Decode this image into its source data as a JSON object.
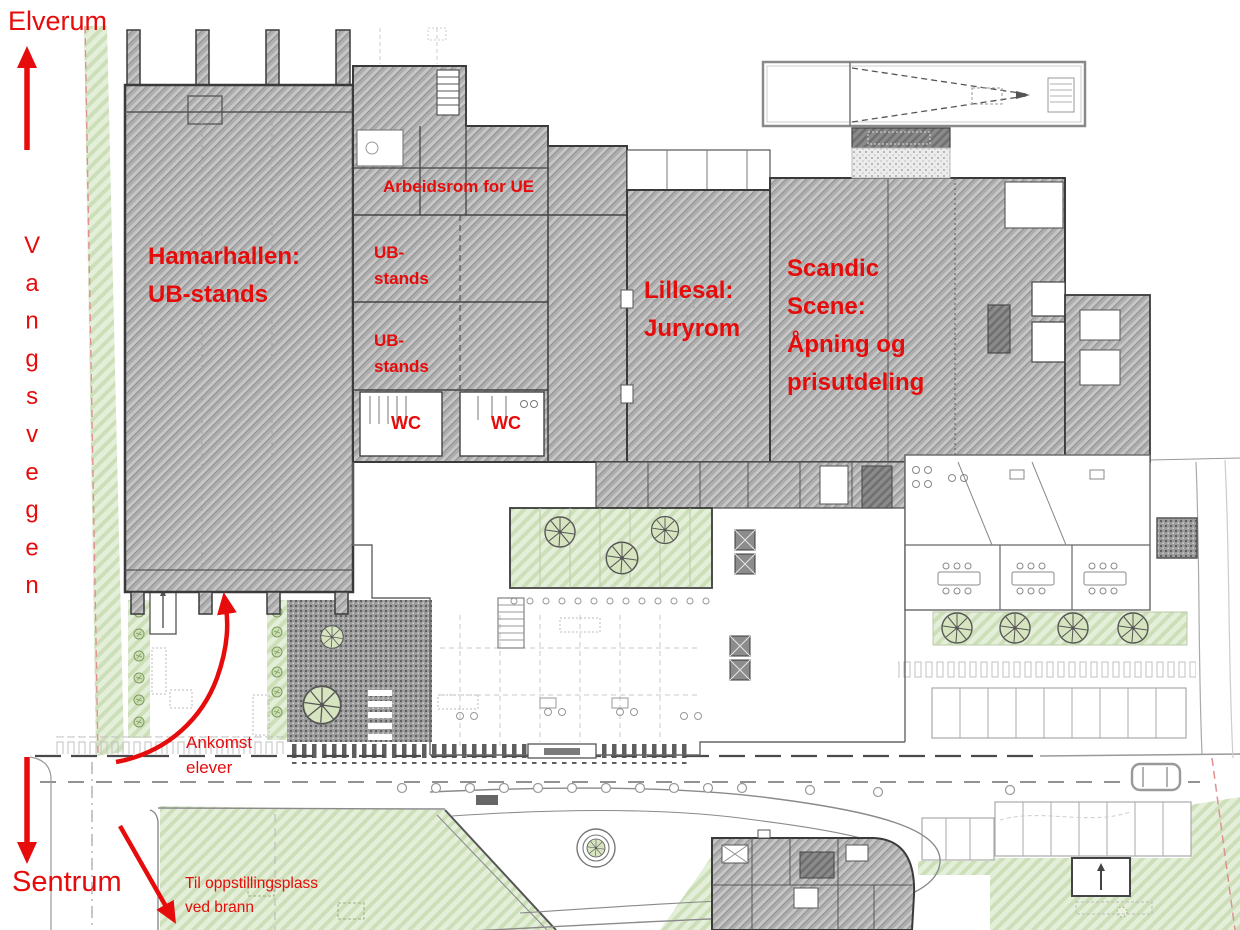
{
  "colors": {
    "annotation_red": "#e60c0c",
    "building_gray": "#adadad",
    "wall_dark": "#3a3a3a",
    "vegetation_green": "#e2edd6"
  },
  "compass": {
    "north": "Elverum",
    "south": "Sentrum",
    "west_road": "Vangsvegen"
  },
  "venues": {
    "hamarhallen": "Hamarhallen:\nUB-stands",
    "work_room": "Arbeidsrom for UE",
    "ub_stands_upper": "UB-\nstands",
    "ub_stands_lower": "UB-\nstands",
    "wc_left": "WC",
    "wc_right": "WC",
    "lillesal": "Lillesal:\nJuryrom",
    "scandic_scene": "Scandic\nScene:\nÅpning og\nprisutdeling"
  },
  "routes": {
    "student_arrival": "Ankomst\nelever",
    "fire_assembly": "Til oppstillingsplass\nved brann"
  }
}
